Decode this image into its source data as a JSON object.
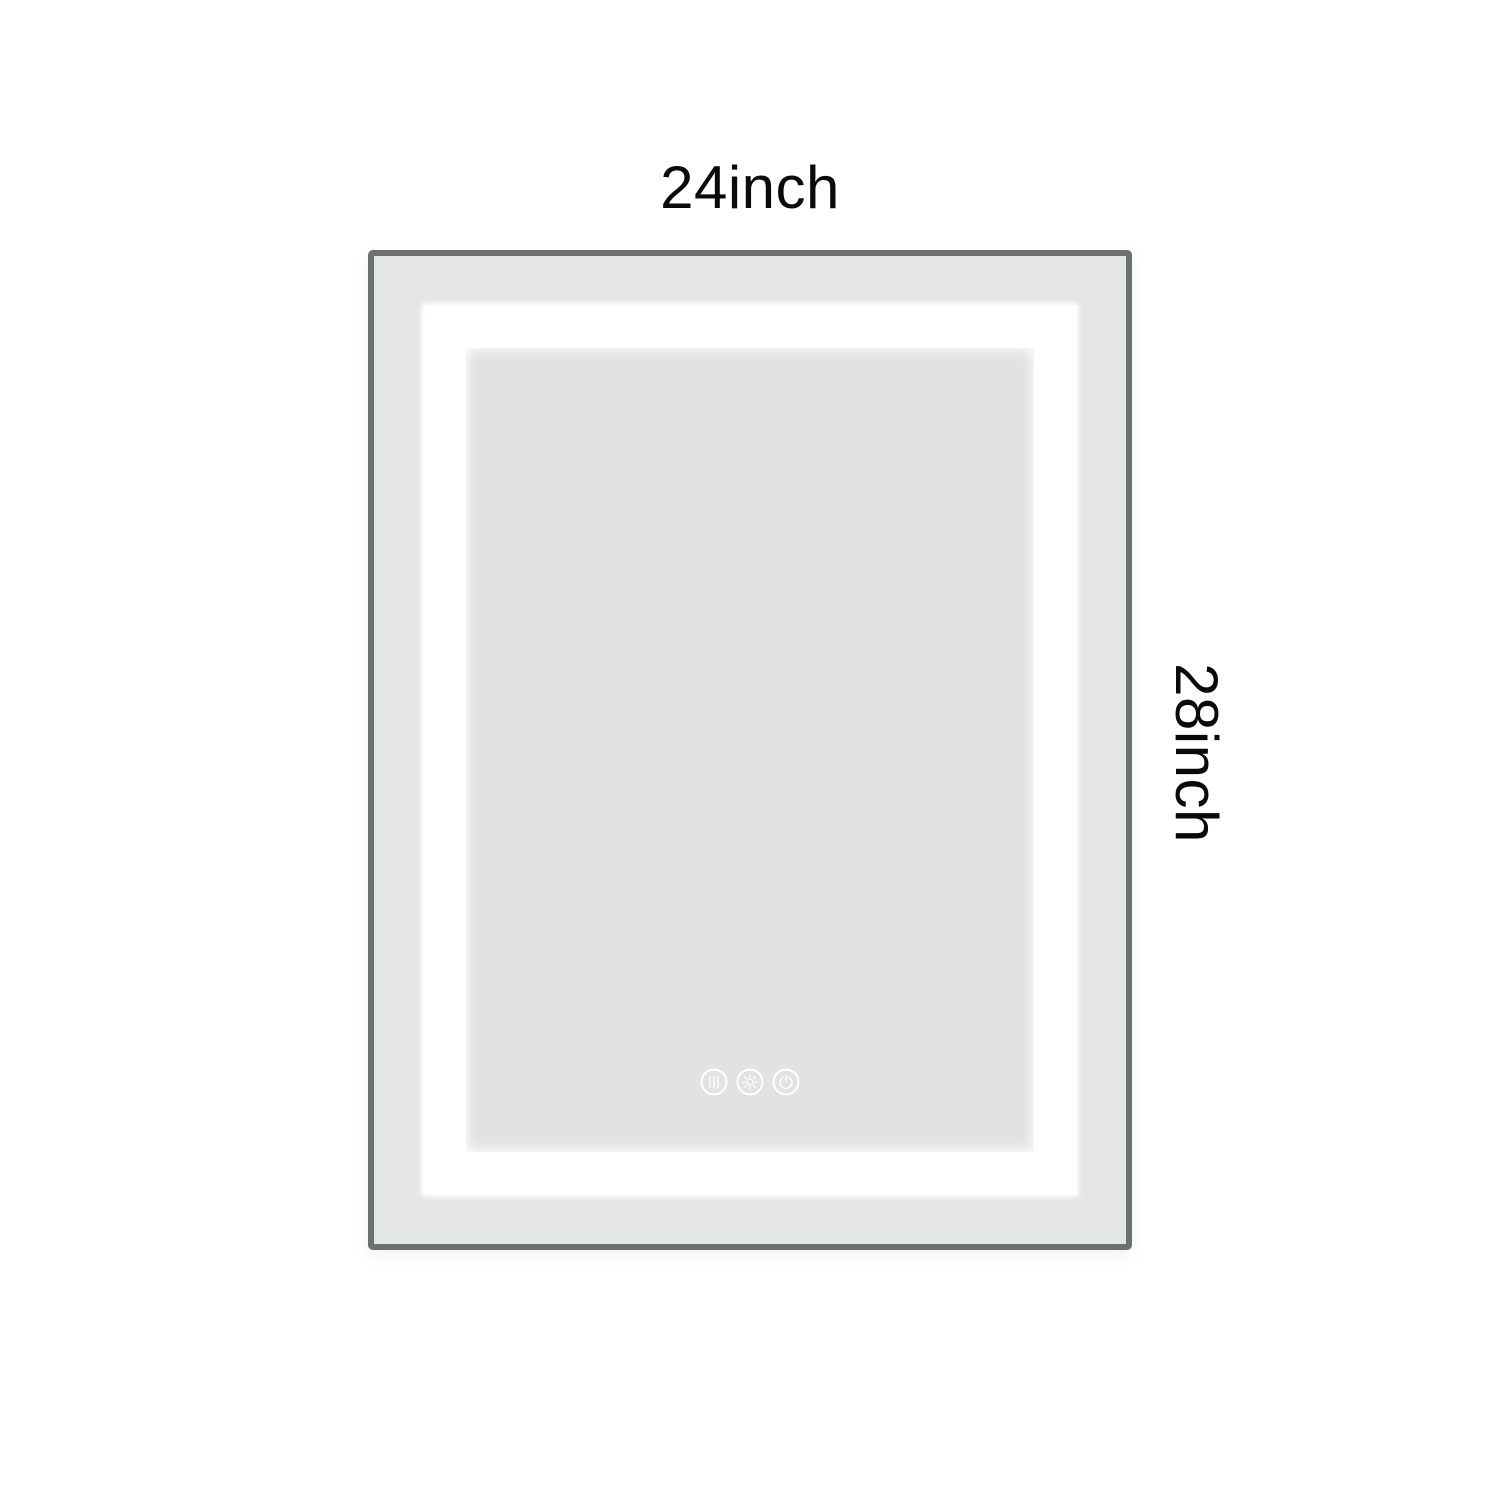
{
  "labels": {
    "width": "24inch",
    "height": "28inch"
  },
  "mirror": {
    "type": "led-bathroom-mirror-dimension-diagram",
    "controls": [
      {
        "id": "anti-fog",
        "icon": "anti-fog-icon",
        "label": "Anti-fog"
      },
      {
        "id": "brightness",
        "icon": "brightness-icon",
        "label": "Brightness"
      },
      {
        "id": "power",
        "icon": "power-icon",
        "label": "Power"
      }
    ],
    "colors": {
      "frame": "#6b7071",
      "face": "#e4e5e6",
      "led_band": "#ffffff",
      "inner_panel": "#e1e2e3",
      "label_text": "#0a0a0a",
      "background": "#ffffff"
    }
  }
}
